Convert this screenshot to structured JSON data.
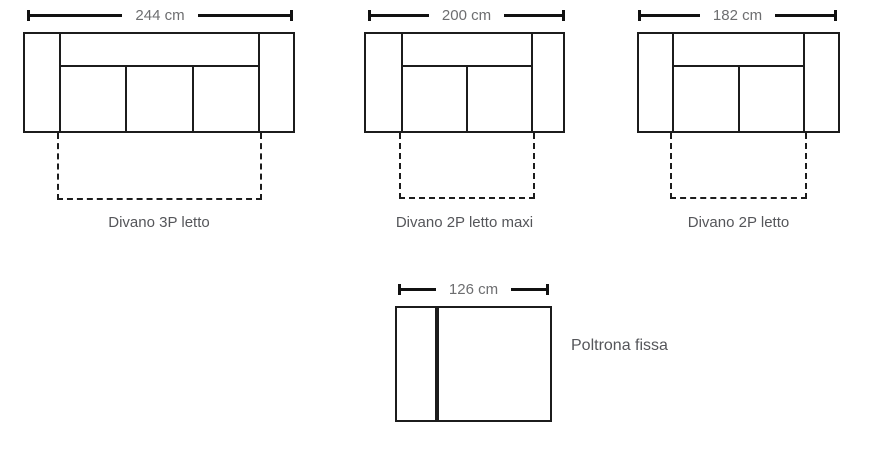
{
  "items": [
    {
      "id": "divano-3p-letto",
      "dimension_label": "244 cm",
      "name_label": "Divano 3P letto",
      "seat_cushions": 3,
      "bed_extension": true
    },
    {
      "id": "divano-2p-letto-maxi",
      "dimension_label": "200 cm",
      "name_label": "Divano 2P letto maxi",
      "seat_cushions": 2,
      "bed_extension": true
    },
    {
      "id": "divano-2p-letto",
      "dimension_label": "182 cm",
      "name_label": "Divano 2P letto",
      "seat_cushions": 2,
      "bed_extension": true
    },
    {
      "id": "poltrona-fissa",
      "dimension_label": "126 cm",
      "name_label": "Poltrona fissa",
      "seat_cushions": 1,
      "bed_extension": false
    }
  ],
  "colors": {
    "outline": "#1c1c1c",
    "dimension_line": "#111111",
    "dimension_text": "#6d6e70",
    "label_text": "#55565a",
    "background": "#ffffff"
  }
}
